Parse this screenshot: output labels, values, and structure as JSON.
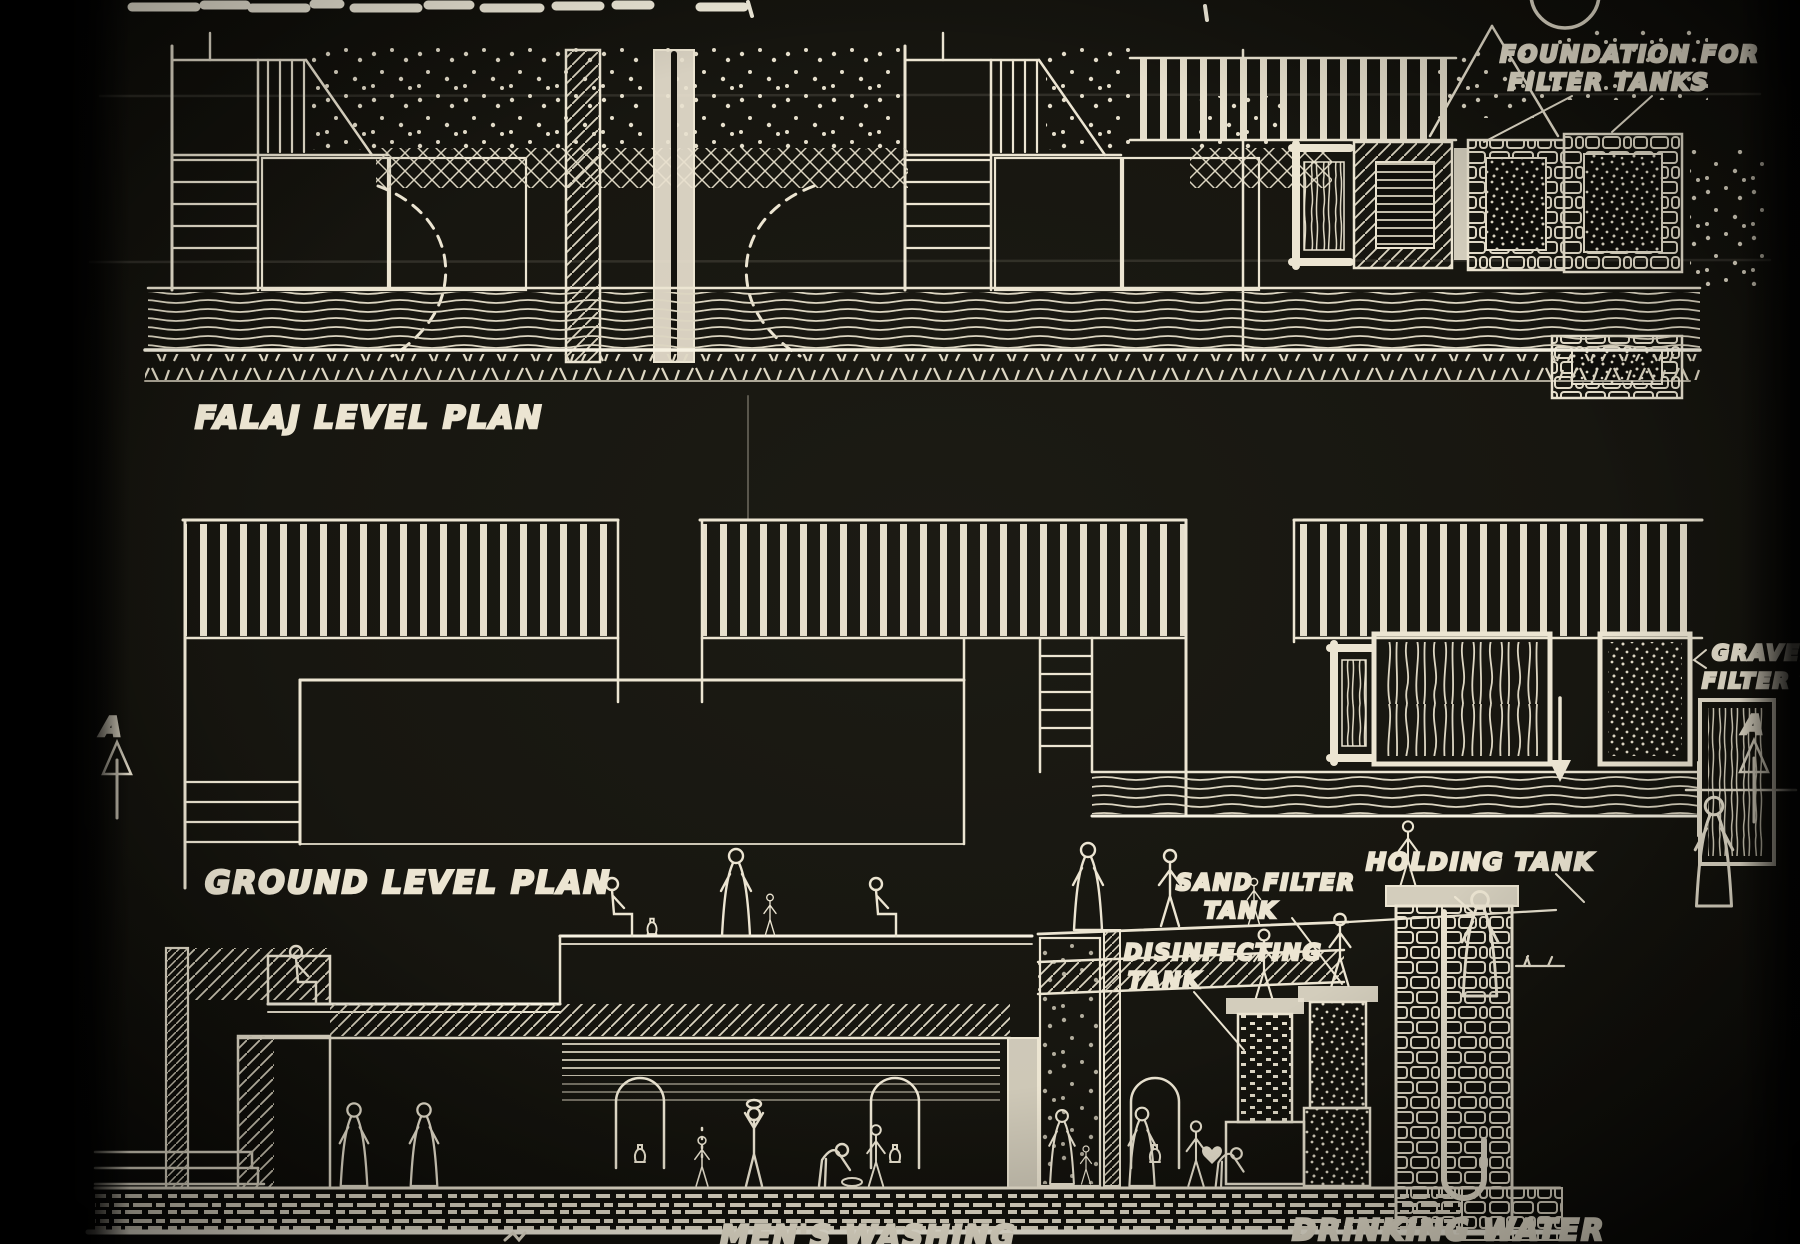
{
  "colors": {
    "ink": "#ece5d2",
    "bright_ink": "#f7f2e2",
    "paper": "#17160f",
    "border": "#050505"
  },
  "panels": {
    "falaj_plan": {
      "title": "FALAJ LEVEL PLAN"
    },
    "ground_plan": {
      "title": "GROUND LEVEL PLAN"
    },
    "section": {
      "labels": {
        "holding_tank": "HOLDING TANK",
        "sand_filter_line1": "SAND FILTER",
        "sand_filter_line2": "TANK",
        "disinfecting_line1": "DISINFECTING",
        "disinfecting_line2": "TANK",
        "drinking_water": "DRINKING WATER",
        "mens_washing": "MEN'S WASHING"
      }
    }
  },
  "annotations": {
    "foundation_line1": "FOUNDATION FOR",
    "foundation_line2": "FILTER TANKS",
    "gravel_line1": "GRAVEL",
    "gravel_line2": "FILTER TA",
    "section_marker_left": "A",
    "section_marker_right": "A"
  }
}
